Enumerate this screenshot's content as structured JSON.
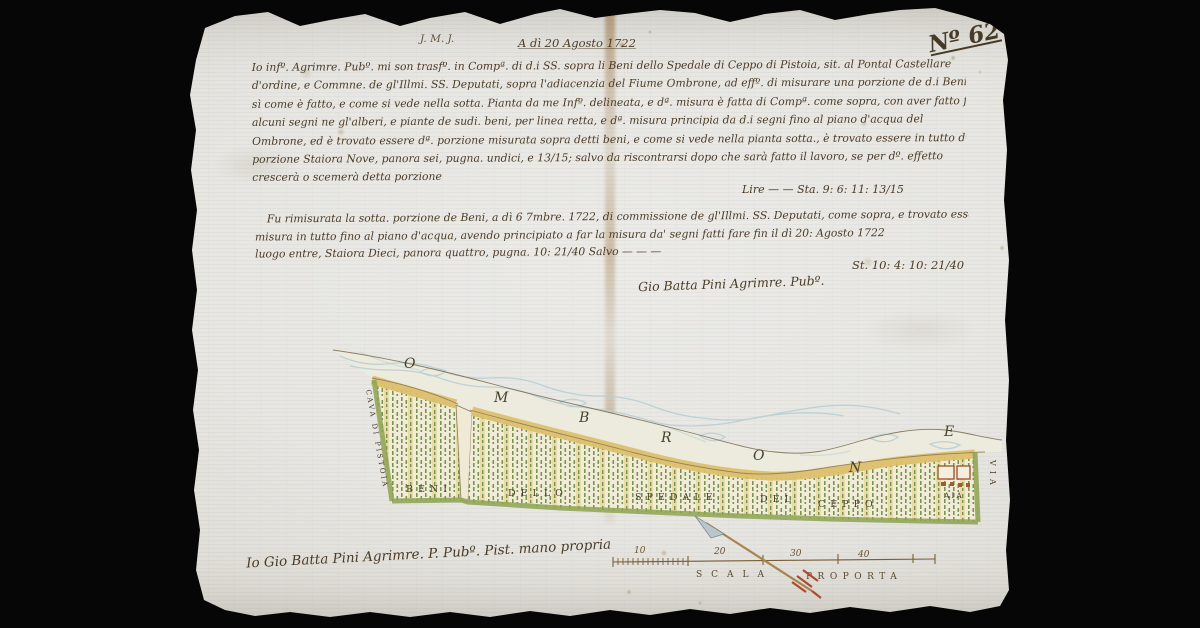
{
  "document": {
    "folio_number": "Nº 62",
    "monogram": "J. M. J.",
    "date_line": "A dì 20 Agosto 1722",
    "body_lines": [
      "Io infº. Agrimre. Pubº. mi son trasfº. in Compª. di d.i SS. sopra li Beni dello Spedale di Ceppo di Pistoia, sit. al Pontal Castellare",
      "d'ordine, e Commne. de gl'Illmi. SS. Deputati, sopra l'adiacenzia del Fiume Ombrone, ad effº. di misurare una porzione de d.i Beni",
      "sì come è fatto, e come si vede nella sotta. Pianta da me Infº. delineata, e dª. misura è fatta di Compª. come sopra, con aver fatto fare",
      "alcuni segni ne gl'alberi, e piante de sudi. beni, per linea retta, e dª. misura principia da d.i segni fino al piano d'acqua del",
      "Ombrone, ed è trovato essere dª. porzione misurata sopra detti beni, e come si vede nella pianta sotta., è trovato essere in tutto dª.",
      "porzione Staiora Nove, panora sei, pugna. undici, e 13/15; salvo da riscontrarsi dopo che sarà fatto il lavoro, se per dº. effetto",
      "crescerà o scemerà detta porzione"
    ],
    "sum_line_1": "Lire — — Sta. 9: 6: 11: 13/15",
    "second_entry_lines": [
      "Fu rimisurata la sotta. porzione de Beni, a dì 6 7mbre. 1722, di commissione de gl'Illmi. SS. Deputati, come sopra, e trovato essere a",
      "misura in tutto fino al piano d'acqua, avendo principiato a far la misura da' segni fatti fare fin il dì 20: Agosto 1722",
      "luogo entre, Staiora Dieci, panora quattro, pugna. 10: 21/40 Salvo — — —"
    ],
    "sum_line_2": "St. 10: 4: 10: 21/40",
    "surveyor_signature": "Gio Batta Pini Agrimre. Pubº.",
    "bottom_signature": "Io Gio Batta Pini Agrimre. P. Pubº. Pist. mano propria"
  },
  "map": {
    "river_letters": [
      "O",
      "M",
      "B",
      "R",
      "O",
      "N",
      "E"
    ],
    "land_words": [
      "BENI",
      "DELLO",
      "SPEDALE",
      "DEL",
      "CEPPO"
    ],
    "left_edge_label": "CAVA DI PISTOIA",
    "right_edge_label": "VIA",
    "aia_label": "AIA",
    "scale_numbers": [
      "10",
      "20",
      "30",
      "40"
    ],
    "scale_label_left": "SCALA",
    "scale_label_right": "PROPORTA"
  },
  "colors": {
    "paper": "#e8e7e2",
    "ink": "#4b3b26",
    "river_blue": "#b6cdd5",
    "bank_yellow": "#ddc06e",
    "field_green": "#6d8a42",
    "edge_green": "#8ea351",
    "building_red": "#a05a32",
    "arrow_red": "#b5482e",
    "background": "#060606"
  }
}
